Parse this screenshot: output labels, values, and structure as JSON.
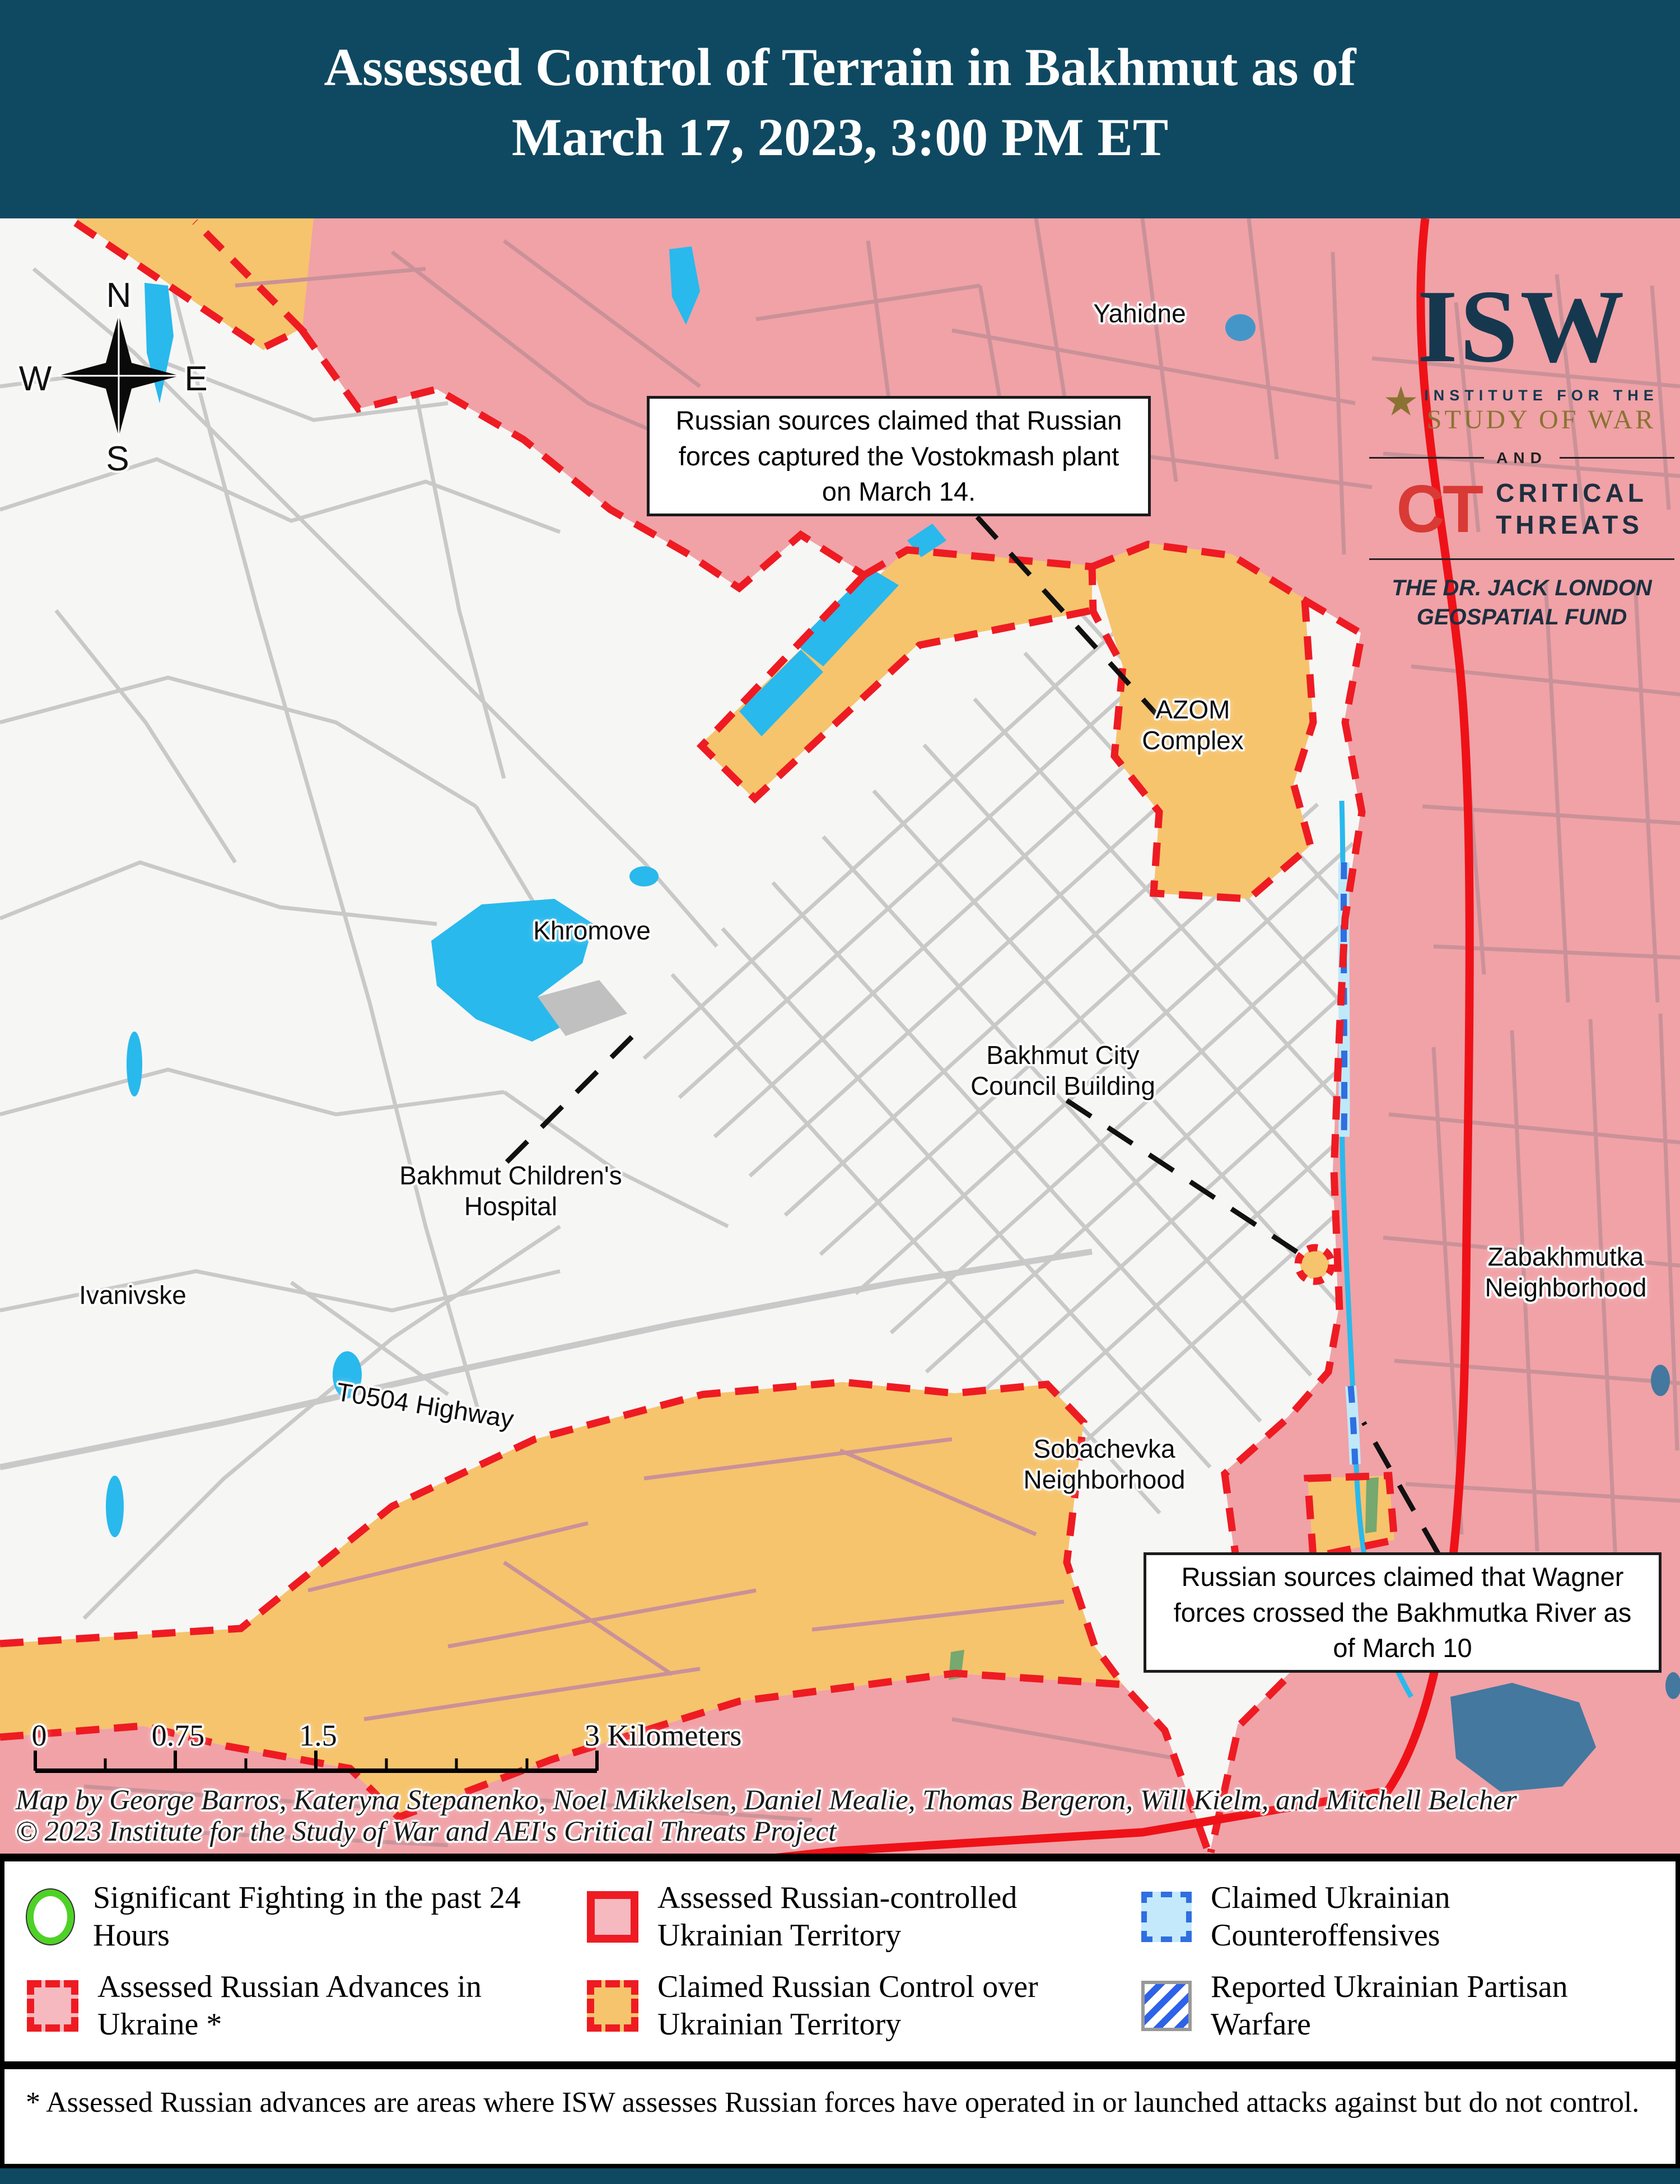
{
  "title": {
    "line1": "Assessed Control of Terrain in Bakhmut as of",
    "line2": "March 17, 2023, 3:00 PM ET"
  },
  "branding": {
    "isw": "ISW",
    "star": "★",
    "institute": "INSTITUTE FOR THE",
    "study_of_war": "STUDY OF WAR",
    "and": "AND",
    "ct": "CT",
    "critical": "CRITICAL",
    "threats": "THREATS",
    "fund_line1": "THE DR. JACK LONDON",
    "fund_line2": "GEOSPATIAL FUND"
  },
  "compass": {
    "n": "N",
    "e": "E",
    "s": "S",
    "w": "W"
  },
  "map_labels": {
    "yahidne": "Yahidne",
    "azom": "AZOM Complex",
    "khromove": "Khromove",
    "council": "Bakhmut City Council Building",
    "hospital": "Bakhmut Children's Hospital",
    "ivanivske": "Ivanivske",
    "highway": "T0504 Highway",
    "sobachevka": "Sobachevka Neighborhood",
    "zabakhmutka": "Zabakhmutka Neighborhood"
  },
  "annotations": {
    "vostokmash": "Russian sources claimed that Russian forces captured the Vostokmash plant on March 14.",
    "wagner": "Russian sources claimed that Wagner forces crossed the Bakhmutka River as of March 10"
  },
  "scale_bar": {
    "tick0": "0",
    "tick075": "0.75",
    "tick15": "1.5",
    "tick3": "3 Kilometers"
  },
  "credits": {
    "line1": "Map by George Barros, Kateryna Stepanenko, Noel Mikkelsen, Daniel Mealie, Thomas Bergeron, Will Kielm, and Mitchell Belcher",
    "line2": "© 2023 Institute for the Study of War and AEI's Critical Threats Project"
  },
  "legend": {
    "items": [
      {
        "key": "significant-fighting",
        "label": "Significant Fighting in the past 24 Hours"
      },
      {
        "key": "russian-controlled",
        "label": "Assessed Russian-controlled Ukrainian Territory"
      },
      {
        "key": "ukrainian-counteroffensives",
        "label": "Claimed Ukrainian Counteroffensives"
      },
      {
        "key": "russian-advances",
        "label": "Assessed Russian Advances in Ukraine *"
      },
      {
        "key": "claimed-russian-control",
        "label": "Claimed Russian Control over Ukrainian Territory"
      },
      {
        "key": "partisan-warfare",
        "label": "Reported Ukrainian Partisan Warfare"
      }
    ]
  },
  "footnote": "* Assessed Russian advances are areas where ISW assesses Russian forces have operated in or launched attacks against but do not control.",
  "colors": {
    "header_bg": "#0f4961",
    "assessed_russian_pink": "#f0a2a7",
    "claimed_russian_orange": "#f6c46d",
    "advance_red": "#ee1b23",
    "water_cyan": "#29b9ec",
    "pond_blue": "#44789f",
    "counteroffensive_blue": "#2f6fe0",
    "fighting_green": "#4fd127",
    "isw_navy": "#16384f",
    "isw_gold": "#8a7332",
    "ct_red": "#d93a35"
  }
}
